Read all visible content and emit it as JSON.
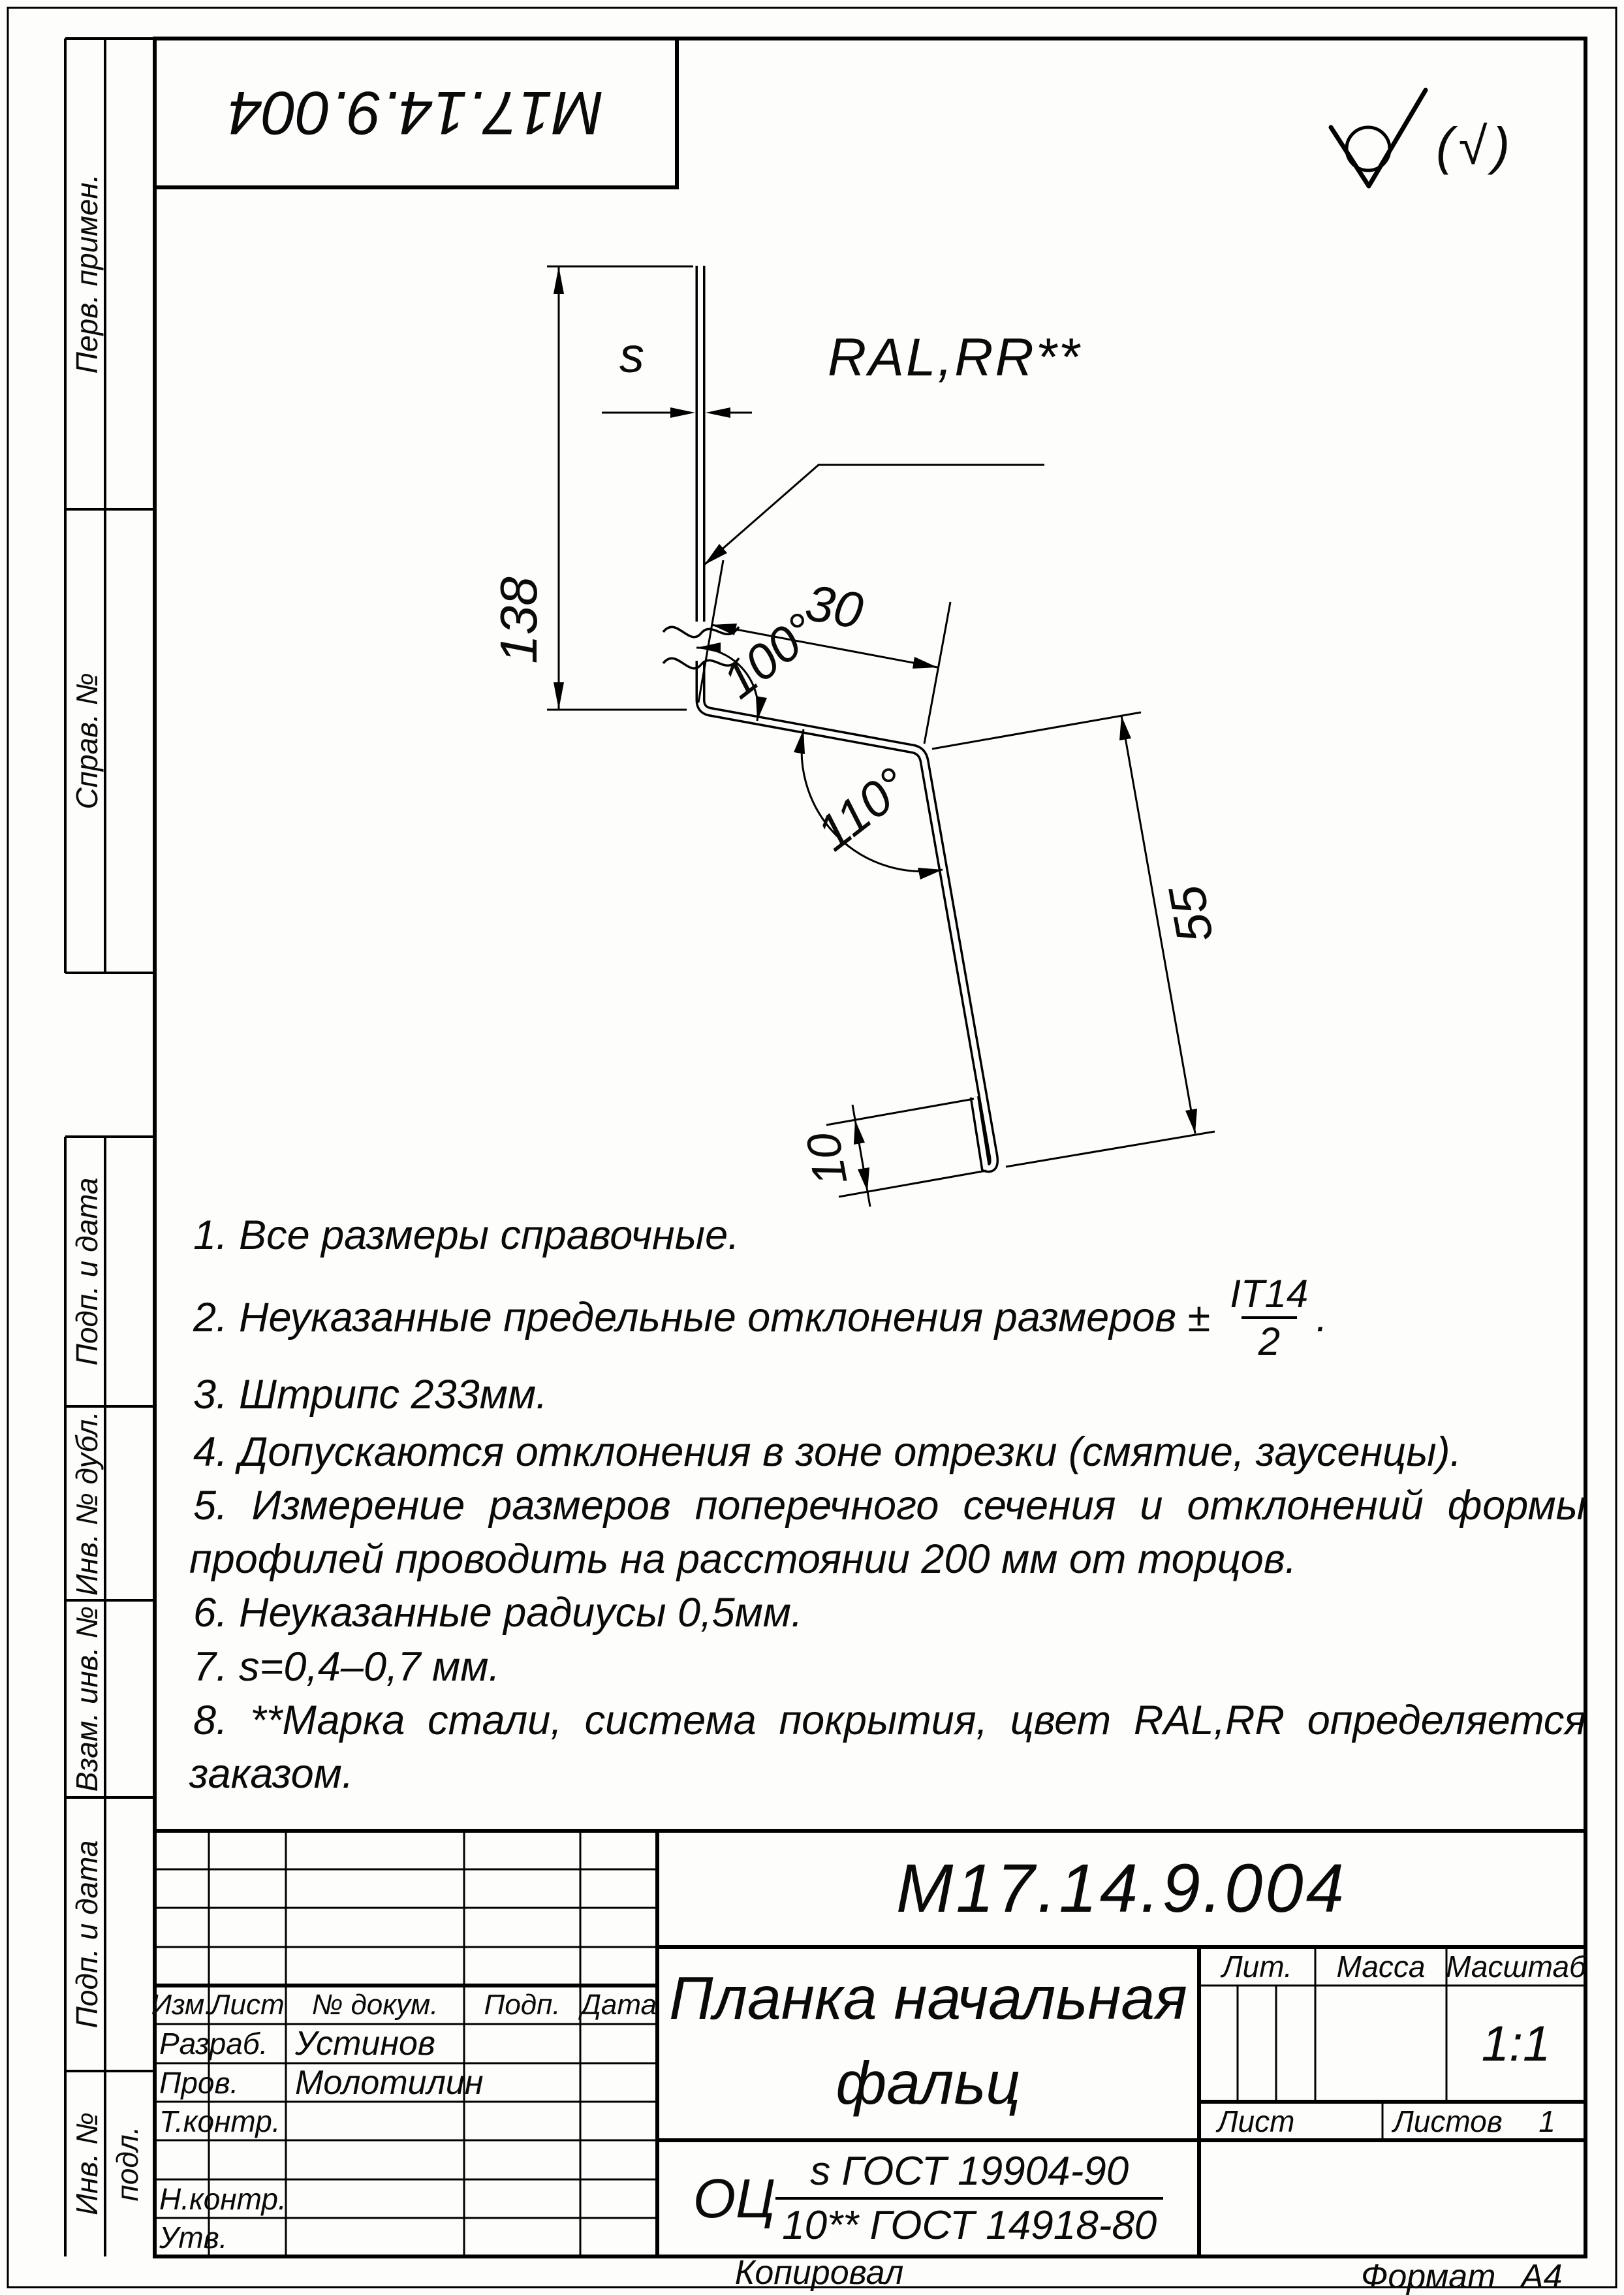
{
  "page": {
    "copied_label": "Копировал",
    "format_label": "Формат",
    "format_value": "А4"
  },
  "stamp_top": {
    "doc_number": "М17.14.9.004"
  },
  "sidebar": {
    "perv_primen": "Перв. примен.",
    "sprav_no": "Справ. №",
    "podp_data_1": "Подп. и дата",
    "inv_dubl": "Инв. № дубл.",
    "vzam_inv": "Взам. инв. №",
    "podp_data_2": "Подп. и дата",
    "inv_podl": "Инв. № подл."
  },
  "drawing": {
    "dim_height": "138",
    "dim_thickness": "s",
    "dim_top_flange": "30",
    "angle_top": "100°",
    "angle_bottom": "110°",
    "dim_leg": "55",
    "dim_hem": "10",
    "coating_label": "RAL,RR**",
    "roughness_alt": "(√)"
  },
  "notes": {
    "n1": "1.  Все размеры справочные.",
    "n2_prefix": "2.  Неуказанные предельные отклонения размеров ±",
    "n2_frac_num": "IT14",
    "n2_frac_den": "2",
    "n2_suffix": ".",
    "n3": "3.  Штрипс 233мм.",
    "n4": "4.  Допускаются отклонения в зоне отрезки (смятие, заусенцы).",
    "n5_line1": "5.  Измерение размеров поперечного сечения и отклонений формы",
    "n5_line2": "профилей проводить на расстоянии 200 мм от торцов.",
    "n6": "6.  Неуказанные радиусы 0,5мм.",
    "n7": "7.  s=0,4–0,7 мм.",
    "n8_line1": "8.  **Марка стали, система покрытия, цвет RAL,RR определяется",
    "n8_line2": "заказом."
  },
  "title_block": {
    "designation": "М17.14.9.004",
    "name_line1": "Планка начальная",
    "name_line2": "фальц",
    "material_prefix": "ОЦ",
    "material_num": "s ГОСТ 19904-90",
    "material_den": "10** ГОСТ 14918-80",
    "header": {
      "izm": "Изм.",
      "list": "Лист",
      "doc": "№ докум.",
      "podp": "Подп.",
      "data": "Дата"
    },
    "rows": {
      "razrab_label": "Разраб.",
      "razrab_name": "Устинов",
      "prov_label": "Пров.",
      "prov_name": "Молотилин",
      "tkontr_label": "Т.контр.",
      "nkontr_label": "Н.контр.",
      "utv_label": "Утв."
    },
    "lit_label": "Лит.",
    "mass_label": "Масса",
    "scale_label": "Масштаб",
    "scale_value": "1:1",
    "sheet_label": "Лист",
    "sheets_label": "Листов",
    "sheets_value": "1"
  }
}
